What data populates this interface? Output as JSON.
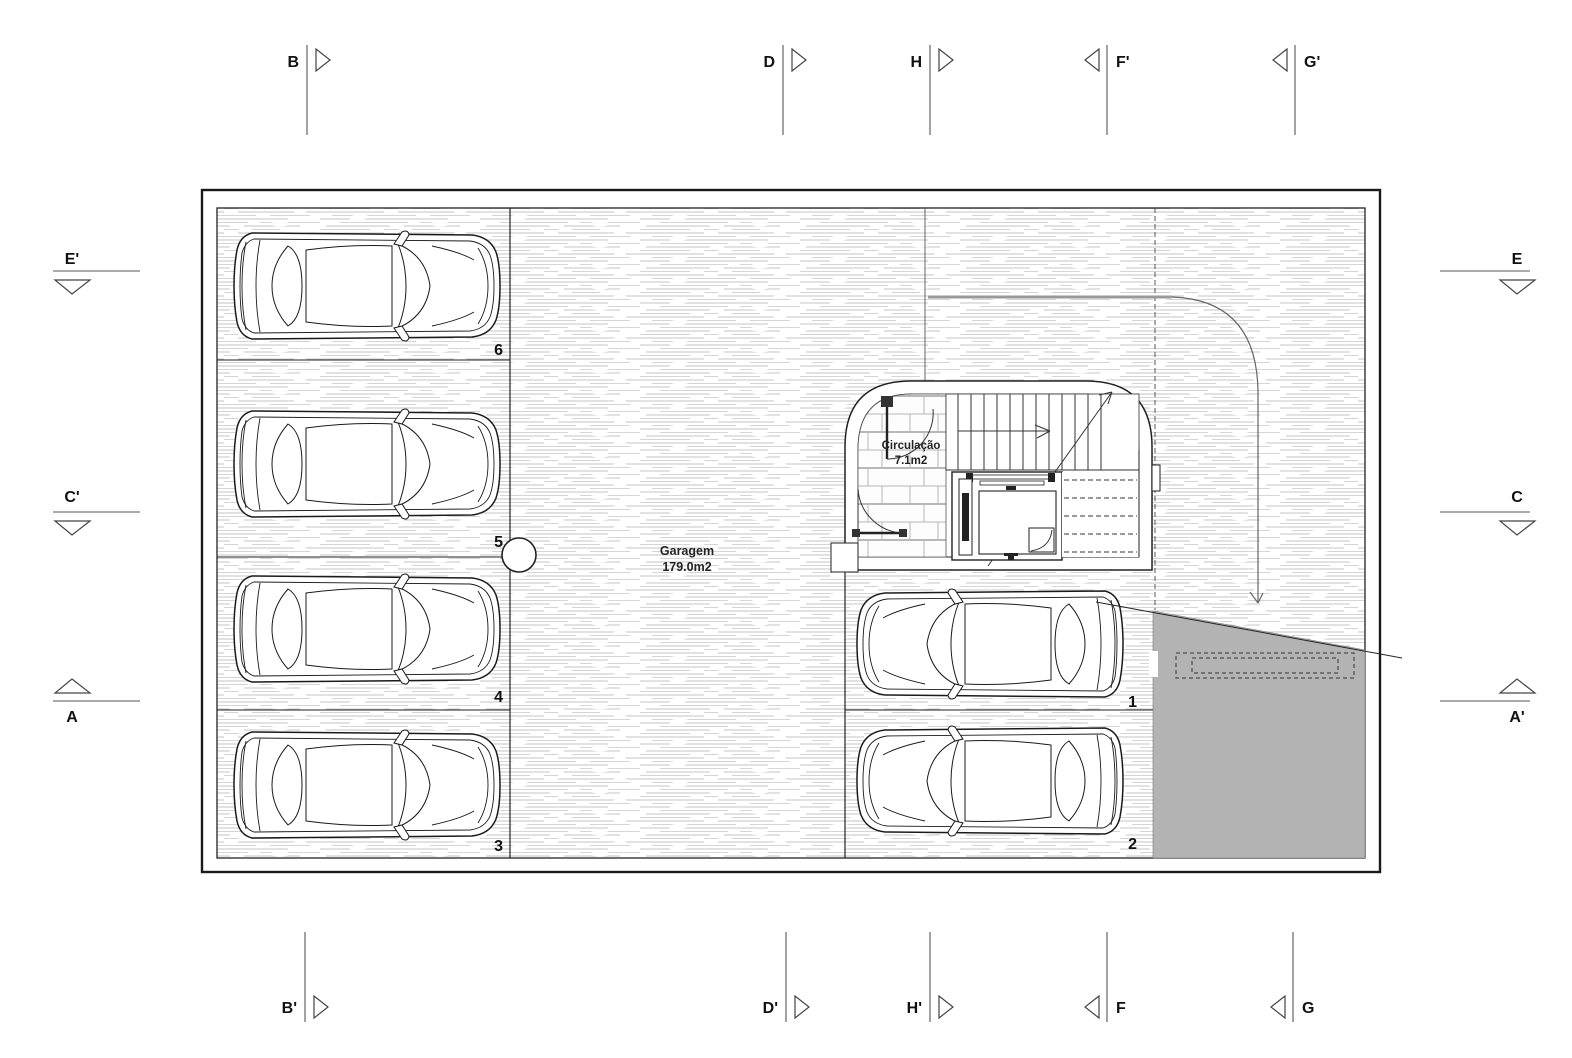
{
  "drawing": {
    "rooms": {
      "garage": {
        "name": "Garagem",
        "area": "179.0m2"
      },
      "circulation": {
        "name": "Circulação",
        "area": "7.1m2"
      }
    },
    "stalls": [
      "1",
      "2",
      "3",
      "4",
      "5",
      "6"
    ],
    "markers": {
      "top": [
        "B",
        "D",
        "H",
        "F'",
        "G'"
      ],
      "bottom": [
        "B'",
        "D'",
        "H'",
        "F",
        "G"
      ],
      "left": [
        "E'",
        "C'",
        "A"
      ],
      "right": [
        "E",
        "C",
        "A'"
      ]
    },
    "colors": {
      "ramp_gray": "#b3b3b3",
      "hatch_line": "#c6c6c6",
      "wall_line": "#222222",
      "drive_path_gray": "#9a9a9a"
    }
  }
}
